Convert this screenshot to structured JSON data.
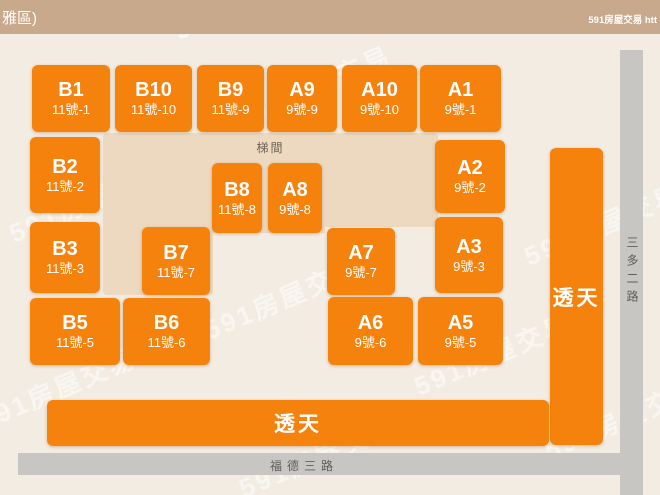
{
  "header": {
    "left_title": "雅區)",
    "right_text": "591房屋交易 htt"
  },
  "map": {
    "stairwell_label": "梯間",
    "blocks": [
      {
        "name": "B1",
        "sub": "11號-1",
        "x": 32,
        "y": 65,
        "w": 78,
        "h": 67
      },
      {
        "name": "B10",
        "sub": "11號-10",
        "x": 115,
        "y": 65,
        "w": 77,
        "h": 67
      },
      {
        "name": "B9",
        "sub": "11號-9",
        "x": 197,
        "y": 65,
        "w": 67,
        "h": 67
      },
      {
        "name": "A9",
        "sub": "9號-9",
        "x": 267,
        "y": 65,
        "w": 70,
        "h": 67
      },
      {
        "name": "A10",
        "sub": "9號-10",
        "x": 342,
        "y": 65,
        "w": 75,
        "h": 67
      },
      {
        "name": "A1",
        "sub": "9號-1",
        "x": 420,
        "y": 65,
        "w": 81,
        "h": 67
      },
      {
        "name": "B2",
        "sub": "11號-2",
        "x": 30,
        "y": 137,
        "w": 70,
        "h": 76
      },
      {
        "name": "A2",
        "sub": "9號-2",
        "x": 435,
        "y": 140,
        "w": 70,
        "h": 73
      },
      {
        "name": "B8",
        "sub": "11號-8",
        "x": 212,
        "y": 163,
        "w": 50,
        "h": 70
      },
      {
        "name": "A8",
        "sub": "9號-8",
        "x": 268,
        "y": 163,
        "w": 54,
        "h": 70
      },
      {
        "name": "B3",
        "sub": "11號-3",
        "x": 30,
        "y": 222,
        "w": 70,
        "h": 71
      },
      {
        "name": "B7",
        "sub": "11號-7",
        "x": 142,
        "y": 227,
        "w": 68,
        "h": 68
      },
      {
        "name": "A7",
        "sub": "9號-7",
        "x": 327,
        "y": 228,
        "w": 68,
        "h": 67
      },
      {
        "name": "A3",
        "sub": "9號-3",
        "x": 435,
        "y": 217,
        "w": 68,
        "h": 76
      },
      {
        "name": "B5",
        "sub": "11號-5",
        "x": 30,
        "y": 298,
        "w": 90,
        "h": 67
      },
      {
        "name": "B6",
        "sub": "11號-6",
        "x": 123,
        "y": 298,
        "w": 87,
        "h": 67
      },
      {
        "name": "A6",
        "sub": "9號-6",
        "x": 328,
        "y": 297,
        "w": 85,
        "h": 68
      },
      {
        "name": "A5",
        "sub": "9號-5",
        "x": 418,
        "y": 297,
        "w": 85,
        "h": 68
      }
    ],
    "townhouse_vertical": {
      "label": "透天"
    },
    "townhouse_horizontal": {
      "label": "透天"
    },
    "roads": {
      "bottom_label": "福德三路",
      "right_label": "三多二路"
    },
    "colors": {
      "unit_orange": "#F6820E",
      "courtyard_tan": "#ECD9C0",
      "background": "#F2ECE3",
      "header_bar": "#C9A98B",
      "road_gray": "#C7C6C3"
    }
  },
  "watermark": {
    "text": "591房屋交易"
  }
}
